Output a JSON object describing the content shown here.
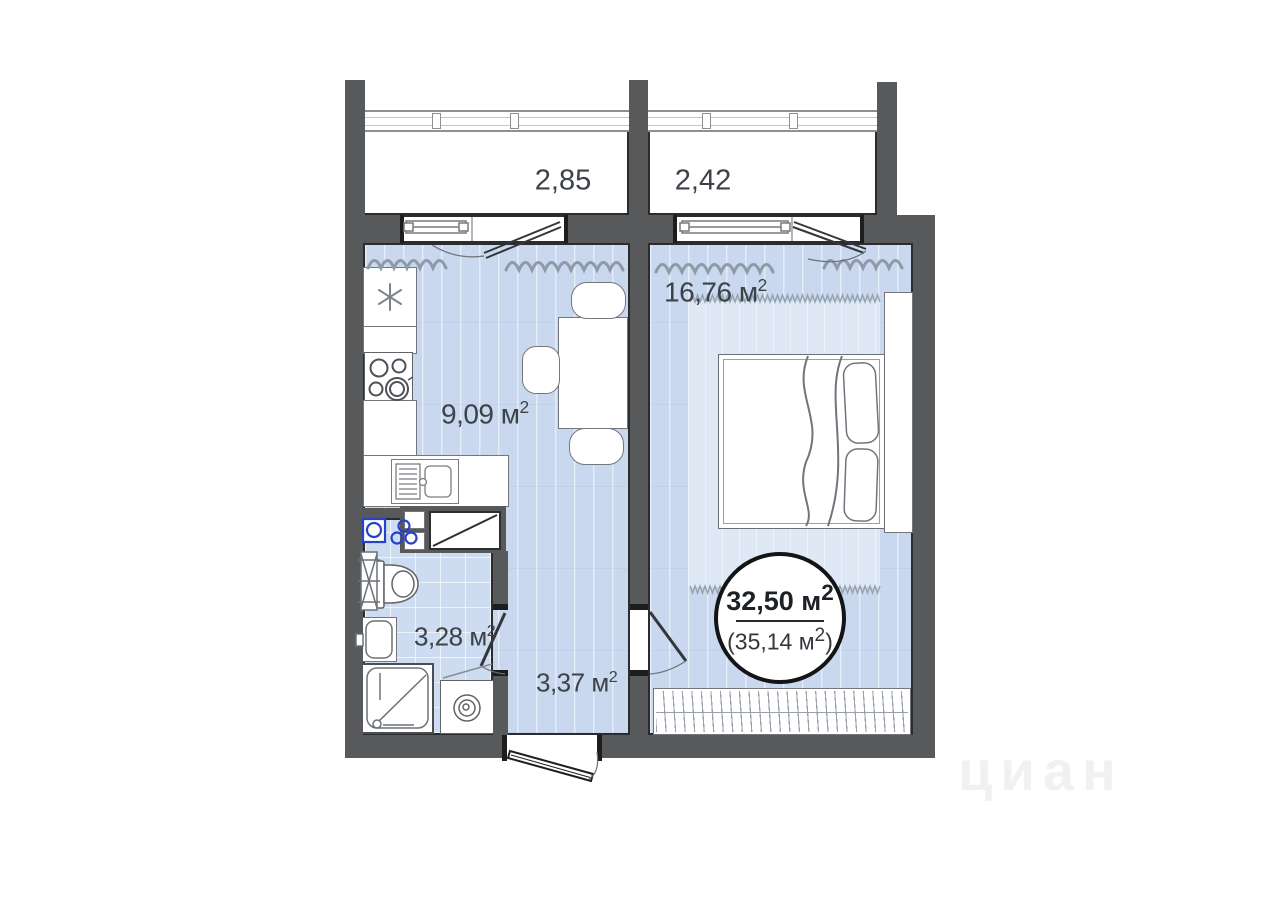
{
  "title": "one-room apartment floor plan",
  "balconies": {
    "left": {
      "area": "2,85"
    },
    "right": {
      "area": "2,42"
    }
  },
  "rooms": {
    "bedroom": {
      "label": "16,76 м",
      "sup": "2"
    },
    "kitchen": {
      "label": "9,09 м",
      "sup": "2"
    },
    "bathroom": {
      "label": "3,28 м",
      "sup": "2"
    },
    "hallway": {
      "label": "3,37 м",
      "sup": "2"
    }
  },
  "total_badge": {
    "main": "32,50 м",
    "main_sup": "2",
    "sub_pre": "(35,14 м",
    "sub_sup": "2",
    "sub_post": ")"
  },
  "watermark": "циан",
  "icons": [
    "snowflake-icon",
    "stove-burners-icon",
    "kitchen-sink-icon",
    "dining-table-icon",
    "chair-icon",
    "toilet-icon",
    "towel-rail-icon",
    "bathroom-sink-icon",
    "shower-icon",
    "washing-machine-icon",
    "washer-connection-icon",
    "riser-pipes-icon",
    "bed-icon",
    "pillow-icon",
    "wardrobe-icon",
    "rug-icon",
    "entrance-door-icon",
    "interior-door-icon",
    "balcony-door-icon",
    "window-sill-icon",
    "curtain-icon",
    "ventilation-shaft-icon"
  ],
  "colors": {
    "wall": "#58595b",
    "outline": "#2a2c2e",
    "floor": "#c9d8ee",
    "bathroom_floor": "#cddcf1",
    "rug": "#dfe9f6",
    "utility_blue": "#2742c8",
    "text": "#3d4249"
  }
}
